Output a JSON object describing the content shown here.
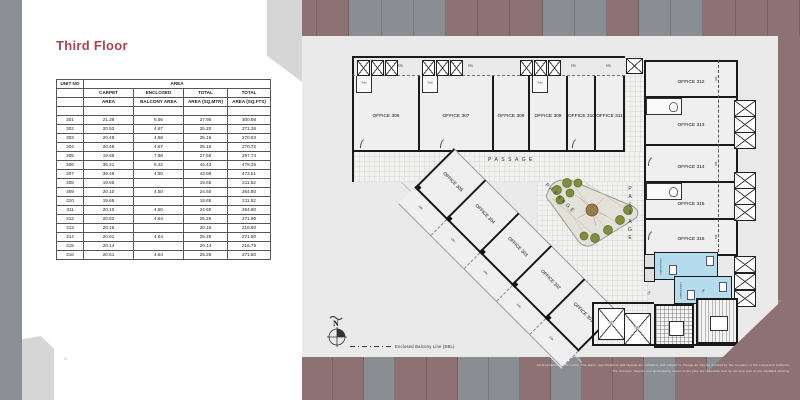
{
  "page": {
    "title": "Third Floor",
    "page_number": "11"
  },
  "table": {
    "header": {
      "unit_no": "UNIT NO",
      "area": "AREA",
      "columns": [
        {
          "l1": "CARPET",
          "l2": "AREA"
        },
        {
          "l1": "ENCLOSED",
          "l2": "BALCONY AREA"
        },
        {
          "l1": "TOTAL",
          "l2": "AREA (SQ.MTR)"
        },
        {
          "l1": "TOTAL",
          "l2": "AREA (SQ.FTS)"
        }
      ]
    },
    "rows": [
      [
        "",
        "",
        "",
        "",
        ""
      ],
      [
        "301",
        "21.39",
        "6.56",
        "27.95",
        "300.86"
      ],
      [
        "302",
        "20.53",
        "4.67",
        "25.20",
        "271.26"
      ],
      [
        "303",
        "20.48",
        "4.68",
        "25.16",
        "270.83"
      ],
      [
        "304",
        "20.48",
        "4.67",
        "25.15",
        "270.72"
      ],
      [
        "305",
        "19.68",
        "7.98",
        "27.66",
        "297.74"
      ],
      [
        "306",
        "36.21",
        "8.22",
        "44.43",
        "478.25"
      ],
      [
        "307",
        "39.49",
        "4.50",
        "43.99",
        "473.51"
      ],
      [
        "308",
        "19.65",
        "",
        "19.65",
        "211.52"
      ],
      [
        "309",
        "20.10",
        "4.50",
        "24.60",
        "264.80"
      ],
      [
        "310",
        "19.65",
        "",
        "19.65",
        "211.52"
      ],
      [
        "311",
        "20.10",
        "4.50",
        "24.60",
        "264.80"
      ],
      [
        "312",
        "20.62",
        "4.64",
        "25.26",
        "271.90"
      ],
      [
        "313",
        "20.15",
        "",
        "20.15",
        "216.90"
      ],
      [
        "314",
        "20.61",
        "4.64",
        "25.25",
        "271.80"
      ],
      [
        "315",
        "20.14",
        "",
        "20.14",
        "216.79"
      ],
      [
        "316",
        "20.61",
        "4.64",
        "25.25",
        "271.80"
      ]
    ]
  },
  "plan": {
    "top_offices": [
      "OFFICE 306",
      "OFFICE 307",
      "OFFICE 308",
      "OFFICE 309",
      "OFFICE 310",
      "OFFICE 311"
    ],
    "right_offices": [
      "OFFICE 312",
      "OFFICE 313",
      "OFFICE 314",
      "OFFICE 315",
      "OFFICE 316"
    ],
    "diagonal_offices": [
      "OFFICE 305",
      "OFFICE 304",
      "OFFICE 303",
      "OFFICE 302",
      "OFFICE 301"
    ],
    "passage_label": "PASSAGE",
    "lift_label": "LIFT",
    "toilet_label": "Toilet",
    "common_toilet_label": "COMMON TOILET",
    "ebl_label": "EBL",
    "up_label": "UP",
    "north_label": "N",
    "legend_label": "Enclosed Balcony Line (EBL)"
  },
  "footer": {
    "disclaimer_line1": "All dimensions are in metric. The plans, specifications and layouts are indicative and subject to change as may be decided by the company or the competent authority.",
    "disclaimer_line2": "The furniture, fixtures and landscaping shown in the plan are indicative and do not form part of the standard offering."
  },
  "colors": {
    "accent": "#a6474d",
    "mauve": "#8e7173",
    "stripegray": "#8a8e92",
    "leftband": "#8c9094",
    "page": "#eaeaea",
    "toiletblue": "#b5dcec",
    "treegreen": "#7d8f3f"
  }
}
